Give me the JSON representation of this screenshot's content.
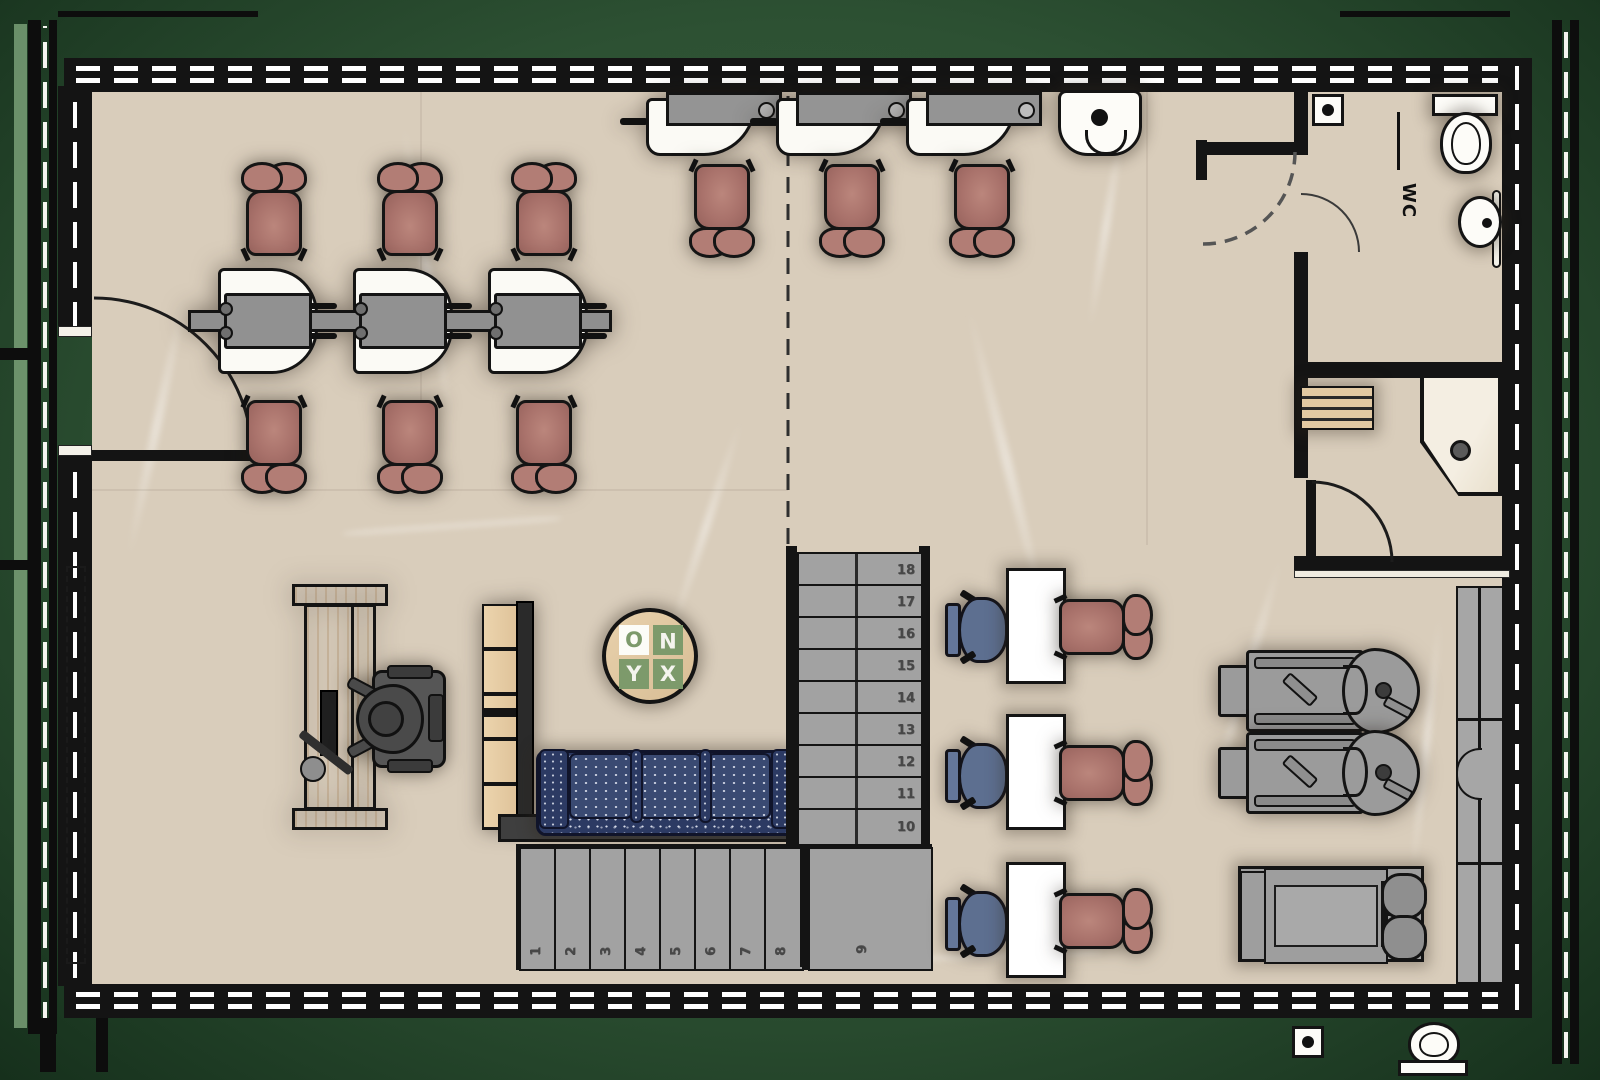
{
  "palette": {
    "exterior_green": "#2d5133",
    "wall_black": "#141414",
    "floor_beige": "#d9cdbb",
    "chair_mauve": "#a9726b",
    "operator_chair_blue": "#5d6f90",
    "sofa_navy": "#2c3a63",
    "wood": "#e5cba2",
    "furniture_gray": "#9b9b9b",
    "logo_green": "#7d9a6b",
    "stair_gray": "#a2a2a2"
  },
  "labels": {
    "wc": "WC"
  },
  "logo": {
    "brand": "ONYX",
    "letters": {
      "o": "O",
      "n": "N",
      "y": "Y",
      "x": "X"
    }
  },
  "stairs": {
    "lower": {
      "steps": [
        "1",
        "2",
        "3",
        "4",
        "5",
        "6",
        "7",
        "8"
      ],
      "landing": "9",
      "direction": "right"
    },
    "upper": {
      "steps": [
        "10",
        "11",
        "12",
        "13",
        "14",
        "15",
        "16",
        "17",
        "18"
      ],
      "direction": "up"
    }
  }
}
